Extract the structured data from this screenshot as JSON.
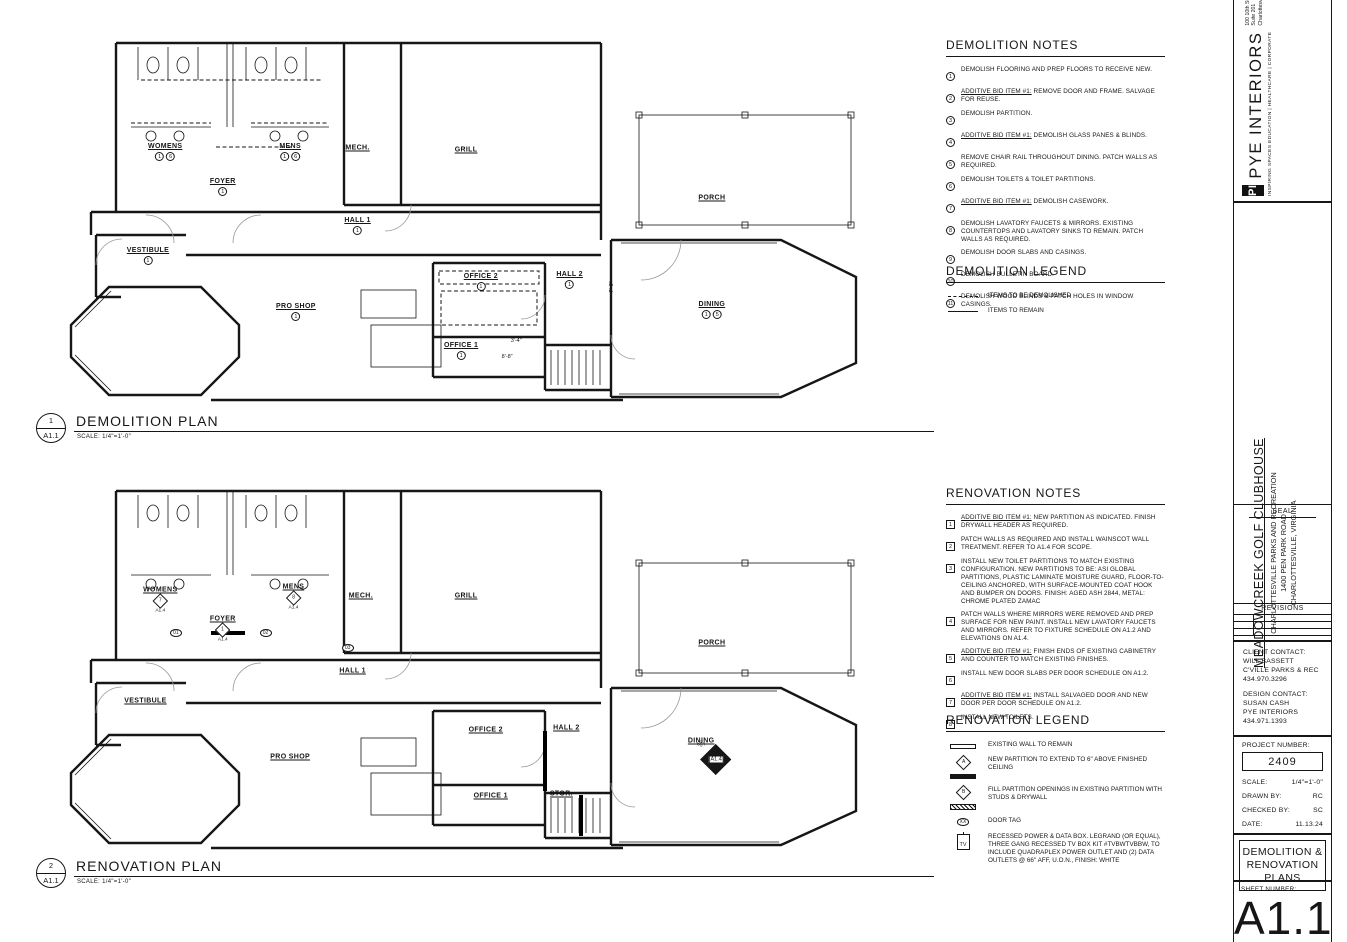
{
  "plans": [
    {
      "number": "1",
      "sheet_ref": "A1.1",
      "title": "DEMOLITION PLAN",
      "scale": "SCALE: 1/4\"=1'-0\"",
      "ref_style": "circ",
      "rooms": [
        {
          "label": "WOMENS",
          "x": 12.8,
          "y": 30.8,
          "refs": [
            "1",
            "6"
          ]
        },
        {
          "label": "MENS",
          "x": 28.0,
          "y": 30.8,
          "refs": [
            "1",
            "6"
          ]
        },
        {
          "label": "FOYER",
          "x": 19.8,
          "y": 40.0,
          "refs": [
            "1"
          ]
        },
        {
          "label": "MECH.",
          "x": 36.2,
          "y": 29.7,
          "refs": []
        },
        {
          "label": "GRILL",
          "x": 49.4,
          "y": 30.3,
          "refs": []
        },
        {
          "label": "PORCH",
          "x": 79.3,
          "y": 42.9,
          "refs": []
        },
        {
          "label": "HALL 1",
          "x": 36.2,
          "y": 50.3,
          "refs": [
            "1"
          ]
        },
        {
          "label": "VESTIBULE",
          "x": 10.7,
          "y": 58.2,
          "refs": [
            "1"
          ]
        },
        {
          "label": "OFFICE 2",
          "x": 51.2,
          "y": 65.0,
          "refs": [
            "1"
          ]
        },
        {
          "label": "HALL 2",
          "x": 62.0,
          "y": 64.5,
          "refs": [
            "1"
          ]
        },
        {
          "label": "PRO SHOP",
          "x": 28.7,
          "y": 72.9,
          "refs": [
            "1"
          ]
        },
        {
          "label": "OFFICE 1",
          "x": 48.8,
          "y": 83.2,
          "refs": [
            "1"
          ]
        },
        {
          "label": "DINING",
          "x": 79.3,
          "y": 72.4,
          "refs": [
            "1",
            "5"
          ]
        }
      ],
      "annotations": [
        {
          "text": "3'-4\"",
          "x": 55.5,
          "y": 80.5,
          "vert": false
        },
        {
          "text": "8'-8\"",
          "x": 54.4,
          "y": 84.7,
          "vert": false
        },
        {
          "text": "7'-6\"",
          "x": 67.1,
          "y": 66.3,
          "vert": true
        }
      ],
      "door_tags": []
    },
    {
      "number": "2",
      "sheet_ref": "A1.1",
      "title": "RENOVATION PLAN",
      "scale": "SCALE: 1/4\"=1'-0\"",
      "ref_style": "sqm",
      "rooms": [
        {
          "label": "WOMENS",
          "x": 12.2,
          "y": 30.8,
          "refs": [],
          "marker": {
            "num": "7",
            "ref": "A1.4"
          }
        },
        {
          "label": "MENS",
          "x": 28.4,
          "y": 30.0,
          "refs": [],
          "marker": {
            "num": "8",
            "ref": "A1.4"
          }
        },
        {
          "label": "FOYER",
          "x": 19.8,
          "y": 38.4,
          "refs": [],
          "marker": {
            "num": "1",
            "ref": "A1.4"
          }
        },
        {
          "label": "MECH.",
          "x": 36.6,
          "y": 29.7,
          "refs": []
        },
        {
          "label": "GRILL",
          "x": 49.4,
          "y": 29.7,
          "refs": []
        },
        {
          "label": "PORCH",
          "x": 79.3,
          "y": 42.1,
          "refs": []
        },
        {
          "label": "HALL 1",
          "x": 35.6,
          "y": 49.5,
          "refs": []
        },
        {
          "label": "VESTIBULE",
          "x": 10.4,
          "y": 57.4,
          "refs": []
        },
        {
          "label": "OFFICE 2",
          "x": 51.8,
          "y": 65.0,
          "refs": []
        },
        {
          "label": "HALL 2",
          "x": 61.6,
          "y": 64.5,
          "refs": []
        },
        {
          "label": "PRO SHOP",
          "x": 28.0,
          "y": 72.1,
          "refs": []
        },
        {
          "label": "OFFICE 1",
          "x": 52.4,
          "y": 82.4,
          "refs": []
        },
        {
          "label": "STOR.",
          "x": 61.0,
          "y": 81.8,
          "refs": []
        },
        {
          "label": "DINING",
          "x": 78.0,
          "y": 67.9,
          "refs": [],
          "big_marker": {
            "center": "A1.4",
            "top": "3",
            "right": "4",
            "bottom": "5",
            "left": "6"
          }
        }
      ],
      "annotations": [],
      "door_tags": [
        {
          "text": "01",
          "x": 14.1,
          "y": 39.5
        },
        {
          "text": "02",
          "x": 25.0,
          "y": 39.5
        },
        {
          "text": "03",
          "x": 35.0,
          "y": 43.4
        }
      ]
    }
  ],
  "demolition_notes": {
    "title": "DEMOLITION NOTES",
    "marker_style": "circ",
    "items": [
      {
        "num": "1",
        "text": "DEMOLISH FLOORING AND PREP FLOORS TO RECEIVE NEW."
      },
      {
        "num": "2",
        "u": "ADDITIVE BID ITEM #1:",
        "text": "REMOVE DOOR AND FRAME.  SALVAGE FOR REUSE."
      },
      {
        "num": "3",
        "text": "DEMOLISH PARTITION."
      },
      {
        "num": "4",
        "u": "ADDITIVE BID ITEM #1:",
        "text": "DEMOLISH GLASS PANES & BLINDS."
      },
      {
        "num": "5",
        "text": "REMOVE CHAIR RAIL THROUGHOUT DINING.  PATCH WALLS AS REQUIRED."
      },
      {
        "num": "6",
        "text": "DEMOLISH TOILETS & TOILET PARTITIONS."
      },
      {
        "num": "7",
        "u": "ADDITIVE BID ITEM #1:",
        "text": "DEMOLISH CASEWORK."
      },
      {
        "num": "8",
        "text": "DEMOLISH LAVATORY FAUCETS & MIRRORS.  EXISTING COUNTERTOPS AND LAVATORY SINKS TO REMAIN.  PATCH WALLS AS REQUIRED."
      },
      {
        "num": "9",
        "text": "DEMOLISH DOOR SLABS AND CASINGS."
      },
      {
        "num": "10",
        "text": "DEMOLISH BULLETIN BOARD."
      },
      {
        "num": "11",
        "text": "DEMOLISH WOOD BLINDS & PATCH HOLES IN WINDOW CASINGS."
      }
    ]
  },
  "demolition_legend": {
    "title": "DEMOLITION LEGEND",
    "items": [
      {
        "symbol": "dashed-line",
        "text": "ITEMS TO BE DEMOLISHED"
      },
      {
        "symbol": "solid-line",
        "text": "ITEMS TO REMAIN"
      }
    ]
  },
  "renovation_notes": {
    "title": "RENOVATION NOTES",
    "marker_style": "sqm",
    "items": [
      {
        "num": "1",
        "u": "ADDITIVE BID ITEM #1:",
        "text": "NEW PARTITION AS INDICATED.  FINISH DRYWALL HEADER AS REQUIRED."
      },
      {
        "num": "2",
        "text": "PATCH WALLS AS REQUIRED AND INSTALL WAINSCOT WALL TREATMENT.  REFER TO A1.4 FOR SCOPE."
      },
      {
        "num": "3",
        "text": "INSTALL NEW TOILET PARTITIONS TO MATCH EXISTING CONFIGURATION.  NEW PARTITIONS TO BE: ASI GLOBAL PARTITIONS, PLASTIC LAMINATE MOISTURE GUARD, FLOOR-TO-CEILING ANCHORED, WITH SURFACE-MOUNTED COAT HOOK AND BUMPER ON DOORS. FINISH: AGED ASH 2844, METAL: CHROME PLATED ZAMAC"
      },
      {
        "num": "4",
        "text": "PATCH WALLS WHERE MIRRORS WERE REMOVED AND PREP SURFACE FOR NEW PAINT.  INSTALL NEW LAVATORY FAUCETS AND MIRRORS.  REFER TO FIXTURE SCHEDULE ON A1.2 AND ELEVATIONS ON A1.4."
      },
      {
        "num": "5",
        "u": "ADDITIVE BID ITEM #1:",
        "text": "FINISH ENDS OF EXISTING CABINETRY AND COUNTER TO MATCH EXISTING FINISHES."
      },
      {
        "num": "6",
        "text": "INSTALL NEW DOOR SLABS PER DOOR SCHEDULE ON A1.2."
      },
      {
        "num": "7",
        "u": "ADDITIVE BID ITEM #1:",
        "text": "INSTALL SALVAGED DOOR AND NEW DOOR PER DOOR SCHEDULE ON A1.2."
      },
      {
        "num": "8",
        "text": "INSTALL NEW TOILETS."
      }
    ]
  },
  "renovation_legend": {
    "title": "RENOVATION LEGEND",
    "items": [
      {
        "symbol": "existing-wall",
        "text": "EXISTING WALL TO REMAIN"
      },
      {
        "symbol": "new-partition",
        "letter": "A",
        "text": "NEW PARTITION TO EXTEND TO 6\" ABOVE FINISHED CEILING"
      },
      {
        "symbol": "fill-partition",
        "letter": "B",
        "text": "FILL PARTITION OPENINGS IN EXISTING PARTITION WITH STUDS & DRYWALL"
      },
      {
        "symbol": "door-tag",
        "letter": "XX",
        "text": "DOOR TAG"
      },
      {
        "symbol": "tv-box",
        "letter": "TV",
        "text": "RECESSED POWER & DATA BOX. LEGRAND (OR EQUAL), THREE GANG RECESSED TV BOX KIT #TVBWTVBBW, TO INCLUDE QUADRAPLEX POWER OUTLET AND (2) DATA OUTLETS @ 66\" AFF, U.O.N., FINISH: WHITE"
      }
    ]
  },
  "titleblock": {
    "firm": {
      "logo": "PI",
      "name": "PYE INTERIORS",
      "address": [
        "100 10th Street, NE",
        "Suite 201",
        "Charlottesville, VA 22902"
      ],
      "contact": [
        "+1 434 971 1393",
        "+1 434 971 1765 fax",
        "pyeinteriors.com"
      ],
      "tagline": "INSPIRING SPACES    EDUCATION | HEALTHCARE | CORPORATE"
    },
    "project": {
      "name": "MEADOWCREEK GOLF CLUBHOUSE",
      "client": "CHARLOTTESVILLE PARKS AND RECREATION",
      "address": "1400 PEN PARK ROAD",
      "city": "CHARLOTTESVILLE, VIRGINIA"
    },
    "seal_label": "SEAL",
    "revisions_label": "REVISIONS",
    "contacts": {
      "client_label": "CLIENT CONTACT:",
      "client_lines": [
        "WILL BASSETT",
        "C'VILLE PARKS & REC",
        "434.970.3296"
      ],
      "design_label": "DESIGN CONTACT:",
      "design_lines": [
        "SUSAN CASH",
        "PYE INTERIORS",
        "434.971.1393"
      ]
    },
    "project_number_label": "PROJECT NUMBER:",
    "project_number": "2409",
    "fields": [
      {
        "label": "SCALE:",
        "value": "1/4\"=1'-0\""
      },
      {
        "label": "DRAWN BY:",
        "value": "RC"
      },
      {
        "label": "CHECKED BY:",
        "value": "SC"
      },
      {
        "label": "DATE:",
        "value": "11.13.24"
      }
    ],
    "sheet_title": [
      "DEMOLITION &",
      "RENOVATION",
      "PLANS"
    ],
    "sheet_number_label": "SHEET NUMBER:",
    "sheet_number": "A1.1"
  }
}
